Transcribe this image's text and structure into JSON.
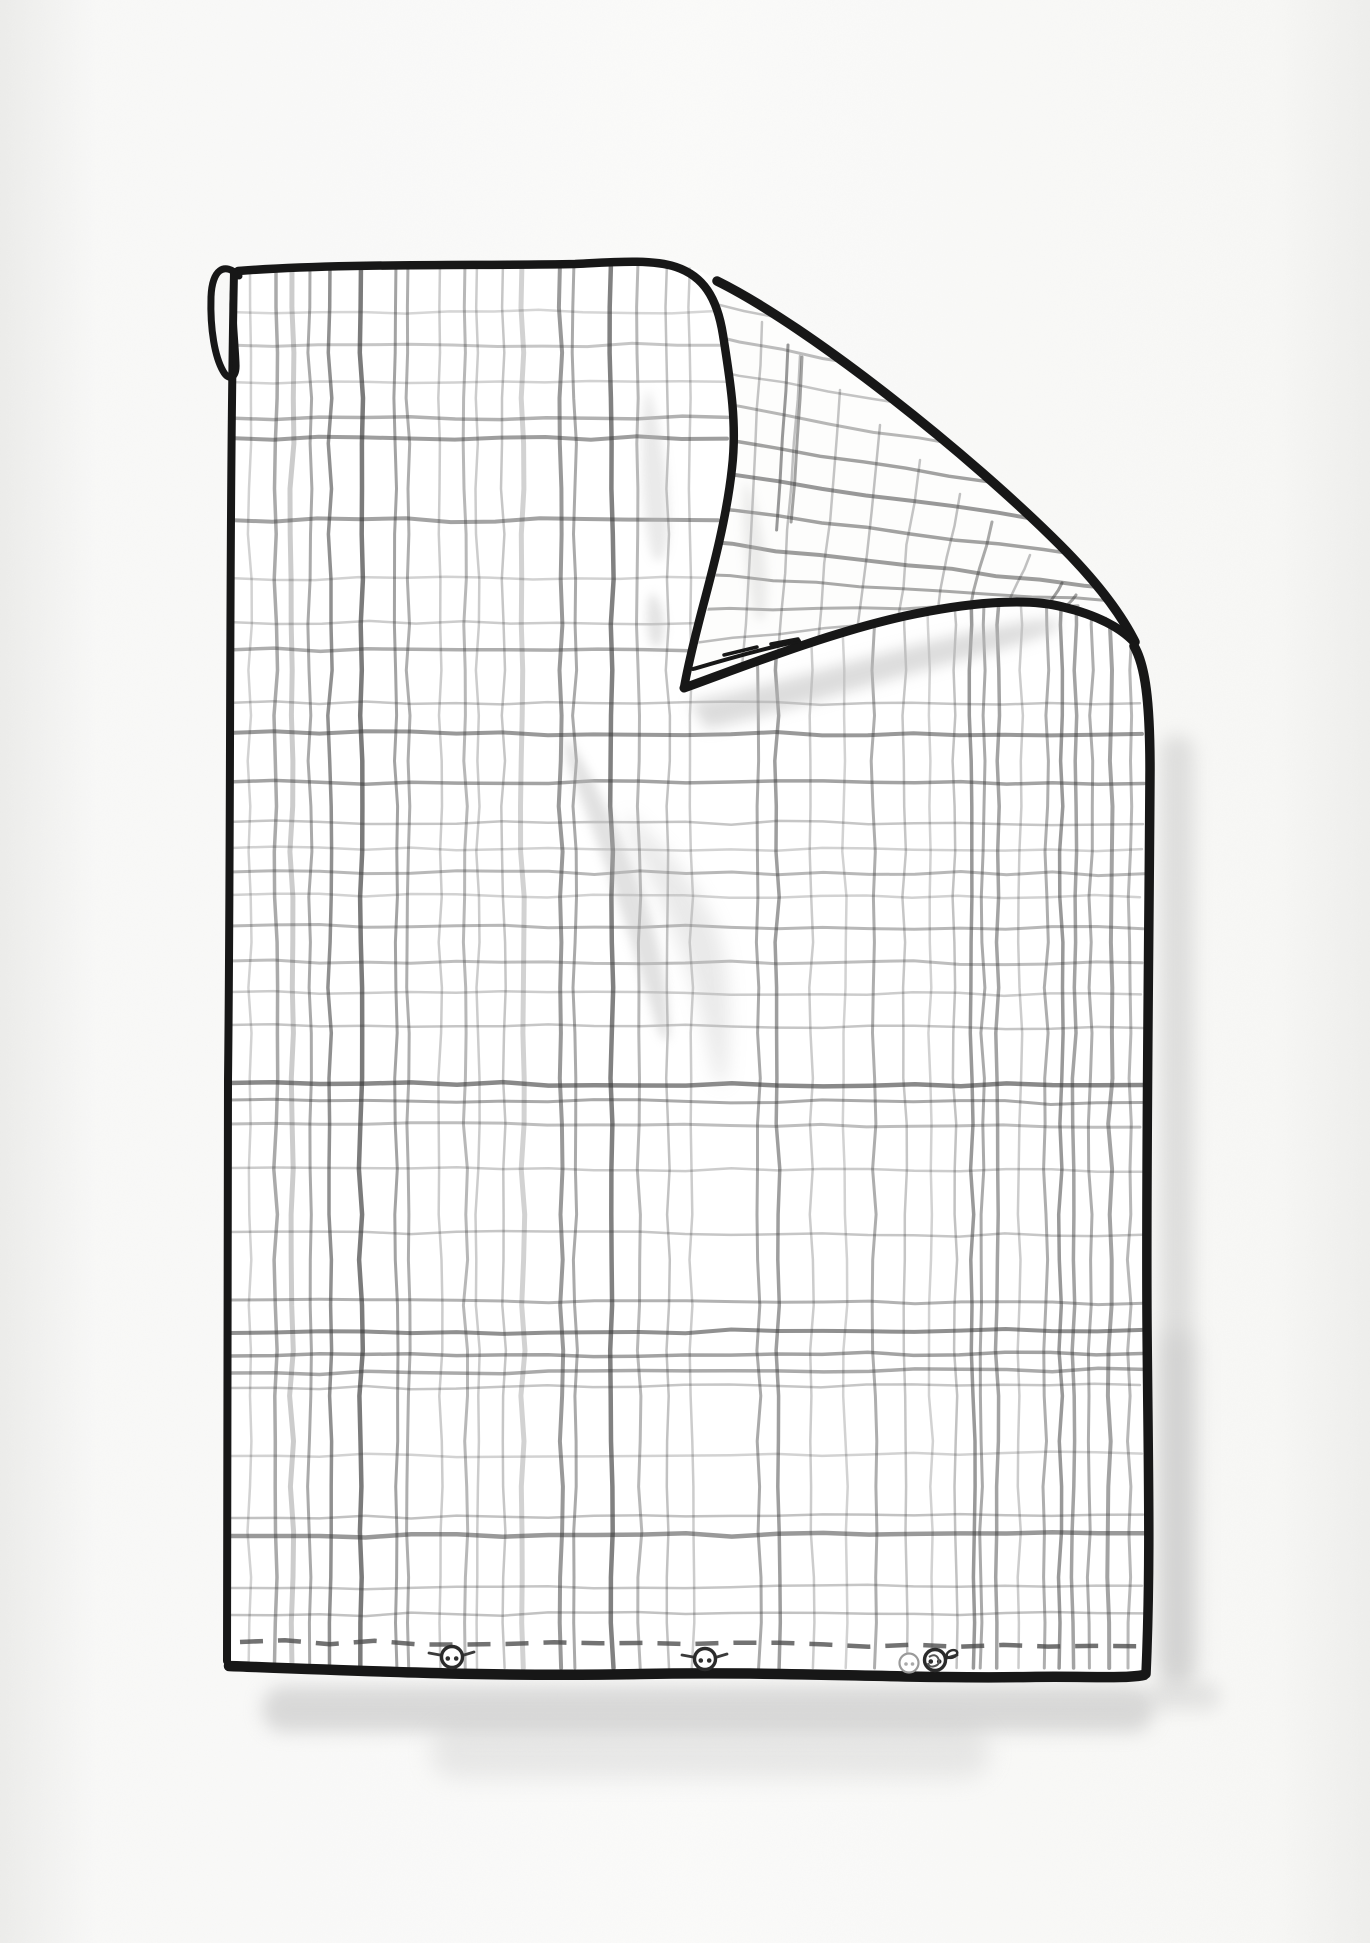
{
  "illustration": {
    "subject": "hand-drawn checked duvet cover with folded-over top-right corner",
    "style": "black ink outline, gray pencil plaid, soft watercolor shadows",
    "canvas": {
      "width": 1370,
      "height": 1943
    },
    "colors": {
      "background": "#f9f9f8",
      "paper_edge": "#ededeb",
      "cloth": "#ffffff",
      "flap_face": "#fdfdfc",
      "ink": "#171717",
      "pencil": "#343434",
      "wash": "#b9b9b9",
      "stitch": "#4a4a4a",
      "button_ring": "#2b2b2b"
    }
  },
  "cloth": {
    "body_path": "M 233,268 C 380,261 540,266 640,262 C 668,260 700,267 717,281 C 810,327 970,455 1060,545 C 1095,580 1120,612 1135,642 C 1146,664 1150,700 1150,770 C 1149,950 1146,1150 1147,1320 C 1148,1460 1151,1560 1146,1672 C 900,1680 520,1668 231,1666 C 227,1420 230,900 233,268 Z",
    "flap_path": "M 702,272 C 720,295 729,350 732,430 C 735,515 706,625 684,688 C 745,666 825,634 905,616 C 965,603 1025,597 1063,607 C 1097,615 1121,628 1134,642 C 1119,611 1094,579 1059,544 C 969,454 809,326 716,280 C 710,277 706,274 702,272 Z",
    "hanging_loop_path": "M 239,276 C 224,261 212,270 211,297 C 210,330 215,357 223,371 C 229,382 237,378 236,363 C 235,337 231,309 234,285",
    "outline_strokes": [
      {
        "name": "top-edge-and-fold-left-edge",
        "d": "M 238,271 C 340,263 480,266 575,264 C 615,262 652,259 676,267 C 703,276 717,297 723,335 C 731,385 737,425 732,468 C 727,515 714,565 702,610 C 695,637 688,665 684,688",
        "w": 8.5
      },
      {
        "name": "crease-edge",
        "d": "M 717,281 C 810,327 970,455 1060,545 C 1095,580 1120,612 1135,642",
        "w": 9.5
      },
      {
        "name": "flap-bottom-edge",
        "d": "M 684,688 C 745,666 825,634 905,616 C 965,603 1025,597 1063,607 C 1097,615 1121,628 1134,642",
        "w": 9
      },
      {
        "name": "flap-hem-inner-line",
        "d": "M 693,669 C 728,659 762,649 799,641",
        "w": 4
      },
      {
        "name": "flap-hem-dashes",
        "d": "M 724,655 L 757,647 M 771,644 L 798,639",
        "w": 3.5
      },
      {
        "name": "right-edge",
        "d": "M 1134,646 C 1145,665 1150,700 1150,770 C 1149,950 1146,1150 1147,1320 C 1148,1460 1151,1560 1146,1674",
        "w": 9.5
      },
      {
        "name": "bottom-edge",
        "d": "M 229,1666 C 360,1671 500,1677 640,1674 C 780,1671 910,1679 1030,1677 C 1085,1676 1122,1679 1144,1675",
        "w": 10.5
      },
      {
        "name": "left-edge",
        "d": "M 234,272 C 229,520 231,820 228,1080 C 226,1330 228,1520 227,1661",
        "w": 8
      }
    ],
    "hem_stitch": {
      "x1": 240,
      "y1": 1642,
      "x2": 1138,
      "y2": 1646,
      "dash": 23,
      "gap": 15,
      "width": 4.5,
      "opacity": 0.78
    }
  },
  "plaid": {
    "front_verticals": [
      [
        250,
        2.5,
        0.22
      ],
      [
        276,
        3.5,
        0.42
      ],
      [
        292,
        5,
        0.25
      ],
      [
        310,
        3,
        0.42
      ],
      [
        330,
        3.5,
        0.55
      ],
      [
        361,
        4.5,
        0.65
      ],
      [
        396,
        3,
        0.45
      ],
      [
        408,
        3,
        0.4
      ],
      [
        440,
        2.5,
        0.25
      ],
      [
        465,
        3,
        0.35
      ],
      [
        477,
        2.5,
        0.25
      ],
      [
        503,
        2.5,
        0.28
      ],
      [
        522,
        5,
        0.22
      ],
      [
        560,
        4,
        0.5
      ],
      [
        574,
        3,
        0.42
      ],
      [
        611,
        4.5,
        0.62
      ],
      [
        638,
        3,
        0.35
      ],
      [
        667,
        2.5,
        0.3
      ],
      [
        690,
        2.5,
        0.25
      ],
      [
        757,
        3,
        0.42
      ],
      [
        776,
        3.5,
        0.48
      ],
      [
        810,
        2.5,
        0.25
      ],
      [
        843,
        2.5,
        0.22
      ],
      [
        872,
        3,
        0.4
      ],
      [
        903,
        2.5,
        0.28
      ],
      [
        928,
        2.5,
        0.22
      ],
      [
        953,
        2.5,
        0.3
      ],
      [
        970,
        3.5,
        0.5
      ],
      [
        985,
        3,
        0.42
      ],
      [
        1000,
        3.5,
        0.45
      ],
      [
        1022,
        2.5,
        0.25
      ],
      [
        1048,
        3,
        0.4
      ],
      [
        1063,
        3.5,
        0.5
      ],
      [
        1076,
        3.5,
        0.45
      ],
      [
        1092,
        3,
        0.4
      ],
      [
        1112,
        4,
        0.45
      ],
      [
        1131,
        3,
        0.35
      ]
    ],
    "front_horizontals": [
      [
        312,
        2.5,
        0.2,
        228,
        716
      ],
      [
        345,
        3,
        0.28,
        228,
        722
      ],
      [
        382,
        2.5,
        0.22,
        228,
        726
      ],
      [
        418,
        3.5,
        0.38,
        228,
        728
      ],
      [
        438,
        4,
        0.48,
        228,
        727
      ],
      [
        520,
        4,
        0.45,
        228,
        718
      ],
      [
        578,
        2.5,
        0.22,
        228,
        707
      ],
      [
        622,
        2.5,
        0.25,
        228,
        698
      ],
      [
        650,
        3.5,
        0.4,
        228,
        690
      ],
      [
        703,
        2.5,
        0.28,
        228,
        1140
      ],
      [
        733,
        4,
        0.5,
        228,
        1142
      ],
      [
        782,
        3.5,
        0.45,
        228,
        1144
      ],
      [
        822,
        2.5,
        0.28,
        228,
        1143
      ],
      [
        848,
        2.5,
        0.22,
        228,
        1142
      ],
      [
        872,
        3,
        0.35,
        228,
        1144
      ],
      [
        895,
        2.5,
        0.22,
        228,
        1140
      ],
      [
        926,
        3,
        0.35,
        228,
        1143
      ],
      [
        961,
        3,
        0.32,
        228,
        1142
      ],
      [
        992,
        2.5,
        0.25,
        228,
        1141
      ],
      [
        1025,
        2.5,
        0.28,
        228,
        1143
      ],
      [
        1083,
        4.5,
        0.58,
        228,
        1144
      ],
      [
        1100,
        3,
        0.42,
        228,
        1142
      ],
      [
        1124,
        3,
        0.32,
        228,
        1140
      ],
      [
        1168,
        2.5,
        0.25,
        228,
        1143
      ],
      [
        1232,
        2.5,
        0.28,
        228,
        1142
      ],
      [
        1300,
        3,
        0.38,
        228,
        1144
      ],
      [
        1333,
        4,
        0.55,
        228,
        1143
      ],
      [
        1356,
        3.5,
        0.45,
        228,
        1142
      ],
      [
        1373,
        3.5,
        0.42,
        228,
        1144
      ],
      [
        1388,
        2.5,
        0.28,
        228,
        1140
      ],
      [
        1456,
        2.5,
        0.22,
        228,
        1142
      ],
      [
        1518,
        2.5,
        0.3,
        228,
        1143
      ],
      [
        1536,
        4.5,
        0.5,
        228,
        1144
      ],
      [
        1588,
        2.5,
        0.28,
        228,
        1142
      ],
      [
        1615,
        2.5,
        0.3,
        228,
        1143
      ]
    ],
    "flap_lines": [
      [
        700,
        300,
        920,
        348,
        2.5,
        0.28
      ],
      [
        698,
        332,
        990,
        392,
        3,
        0.32
      ],
      [
        695,
        366,
        1050,
        432,
        2.5,
        0.28
      ],
      [
        694,
        400,
        1098,
        470,
        3,
        0.35
      ],
      [
        692,
        436,
        1120,
        502,
        3.5,
        0.45
      ],
      [
        690,
        470,
        1130,
        532,
        4,
        0.5
      ],
      [
        689,
        506,
        1132,
        562,
        3.5,
        0.45
      ],
      [
        688,
        540,
        1128,
        590,
        4,
        0.48
      ],
      [
        687,
        574,
        1118,
        602,
        3,
        0.42
      ],
      [
        686,
        610,
        1078,
        606,
        3,
        0.38
      ],
      [
        687,
        644,
        1008,
        608,
        2.5,
        0.32
      ],
      [
        762,
        322,
        742,
        668,
        2.5,
        0.28
      ],
      [
        800,
        356,
        778,
        660,
        2.5,
        0.3
      ],
      [
        788,
        345,
        776,
        530,
        3,
        0.5
      ],
      [
        802,
        357,
        791,
        522,
        3,
        0.45
      ],
      [
        840,
        390,
        818,
        650,
        2.5,
        0.28
      ],
      [
        880,
        425,
        856,
        640,
        2.5,
        0.3
      ],
      [
        920,
        460,
        896,
        630,
        2.5,
        0.28
      ],
      [
        960,
        494,
        936,
        621,
        2.5,
        0.3
      ],
      [
        992,
        522,
        969,
        615,
        3,
        0.42
      ],
      [
        1030,
        555,
        1006,
        611,
        2.5,
        0.3
      ],
      [
        1062,
        583,
        1046,
        611,
        3,
        0.48
      ],
      [
        1076,
        595,
        1061,
        613,
        3,
        0.45
      ],
      [
        1106,
        618,
        1090,
        621,
        2.5,
        0.3
      ]
    ]
  },
  "smudges": [
    {
      "name": "fold-cast-shadow",
      "type": "path",
      "d": "M 690,702 C 770,686 880,652 980,630 C 1030,620 1056,617 1060,624 C 1063,632 1000,650 938,666 C 858,688 760,718 706,729 Z",
      "blur": "b7",
      "o": 0.5,
      "layer": "face"
    },
    {
      "name": "fold-shadow-tail",
      "type": "path",
      "d": "M 652,592 C 661,601 667,618 663,638 C 659,654 650,649 648,630 C 646,611 648,598 652,592 Z",
      "blur": "b5",
      "o": 0.4,
      "layer": "face"
    },
    {
      "name": "center-smudge",
      "type": "path",
      "d": "M 566,736 C 591,771 621,832 646,902 C 661,947 669,992 669,1033 C 669,1047 660,1041 652,1011 C 635,951 605,861 580,796 C 570,769 562,749 566,736 Z",
      "blur": "b5",
      "o": 0.42,
      "layer": "face"
    },
    {
      "name": "center-smudge-lobe",
      "type": "path",
      "d": "M 626,812 C 661,842 696,882 716,927 C 729,960 731,1012 727,1069 C 725,1093 717,1089 711,1061 C 701,1001 677,931 649,877 C 636,851 625,828 626,812 Z",
      "blur": "b9",
      "o": 0.3,
      "layer": "face"
    },
    {
      "name": "flap-left-wedge",
      "type": "path",
      "d": "M 649,389 C 659,421 669,471 669,521 C 669,553 661,569 653,557 C 645,539 641,471 642,431 C 643,407 645,393 649,389 Z",
      "blur": "b5",
      "o": 0.3,
      "layer": "face"
    },
    {
      "name": "flap-inner-wedge",
      "type": "path",
      "d": "M 746,481 C 757,501 765,541 767,581 C 768,611 763,629 756,617 C 749,601 743,541 743,511 C 743,493 744,485 746,481 Z",
      "blur": "b5",
      "o": 0.25,
      "layer": "flap"
    },
    {
      "name": "right-side-shadow",
      "type": "rect",
      "x": 1160,
      "y": 735,
      "w": 34,
      "h": 950,
      "rx": 16,
      "blur": "b9",
      "o": 0.4,
      "layer": "under"
    },
    {
      "name": "right-side-shadow-lower",
      "type": "rect",
      "x": 1157,
      "y": 1330,
      "w": 40,
      "h": 352,
      "rx": 18,
      "blur": "b12",
      "o": 0.3,
      "layer": "under"
    },
    {
      "name": "bottom-shadow",
      "type": "rect",
      "x": 262,
      "y": 1686,
      "w": 892,
      "h": 46,
      "rx": 22,
      "blur": "b9",
      "o": 0.5,
      "layer": "under"
    },
    {
      "name": "bottom-shadow-soft",
      "type": "rect",
      "x": 430,
      "y": 1726,
      "w": 560,
      "h": 52,
      "rx": 26,
      "blur": "b12",
      "o": 0.28,
      "layer": "under"
    },
    {
      "name": "bottom-right-shadow",
      "type": "rect",
      "x": 1148,
      "y": 1682,
      "w": 72,
      "h": 28,
      "rx": 13,
      "blur": "b9",
      "o": 0.32,
      "layer": "under"
    }
  ],
  "buttons": {
    "radius": 10.5,
    "count": 3,
    "items": [
      {
        "cx": 452,
        "cy": 1657,
        "wings": "both",
        "scribble": false
      },
      {
        "cx": 705,
        "cy": 1659,
        "wings": "both",
        "scribble": false
      },
      {
        "cx": 935,
        "cy": 1660,
        "wings": "right",
        "scribble": true
      }
    ],
    "ghost": {
      "cx": 909,
      "cy": 1663,
      "r": 9.5
    }
  }
}
